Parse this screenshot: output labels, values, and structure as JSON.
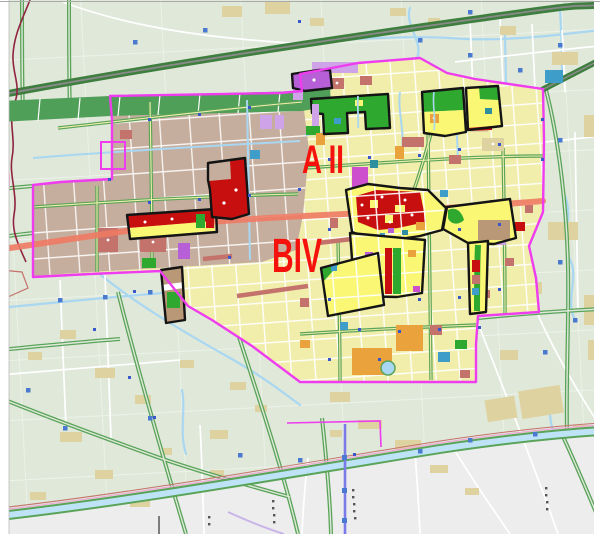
{
  "map": {
    "labels": {
      "district_a": "A II",
      "district_b": "BIV"
    },
    "palette": {
      "rural": "#dfe8d9",
      "outside": "#ededed",
      "urbanYellow": "#f1eeab",
      "districtYellow": "#f9f774",
      "tan": "#c6ae9e",
      "tanPatch": "#ded2a0",
      "beltGreen": "#4f9f58",
      "parkGreen": "#2fa82f",
      "roadGreen": "#5aa45a",
      "highwayGreen": "#3e7e3e",
      "water": "#a9d7f2",
      "canal": "#bfe3f6",
      "magenta": "#ee3cee",
      "red": "#c80f0f",
      "softRed": "#c4736c",
      "redRoad": "#ee7a63",
      "orange": "#eaa33c",
      "purple": "#b75fd6",
      "lavender": "#cfa3e8",
      "violet": "#cd4fcd",
      "blueParcel": "#3f9ec9",
      "teal": "#2f8f9f",
      "dotBlue": "#3a57c9",
      "bridgeBlue": "#4a7ad0",
      "maroon": "#8f2440",
      "labelRed": "#f5120c",
      "white": "#ffffff",
      "brown": "#b99877",
      "roadPurple": "#7a7ae8",
      "pink": "#f0a8d8",
      "grayCenter": "#8a8a8a",
      "black": "#141414",
      "tick": "#555555"
    }
  }
}
